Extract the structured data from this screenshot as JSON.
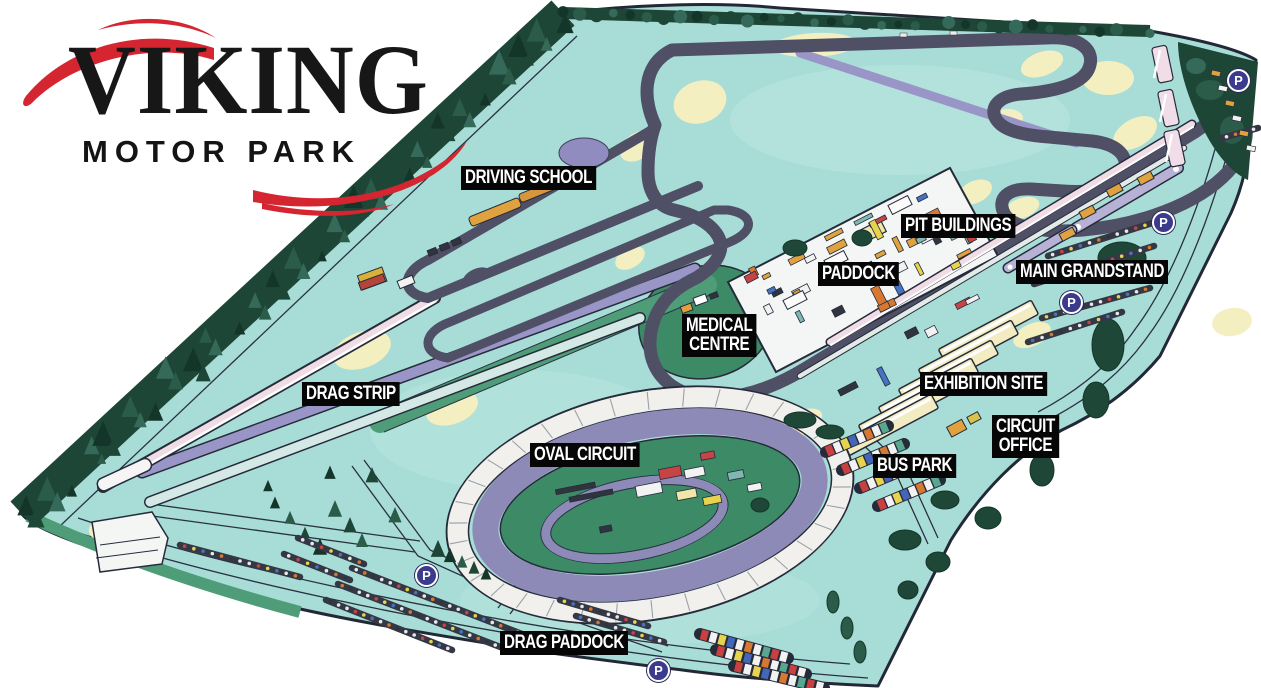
{
  "logo": {
    "title": "VIKING",
    "subtitle": "MOTOR PARK",
    "accent_color": "#d42531",
    "text_color": "#171717"
  },
  "map": {
    "background_color": "#ffffff",
    "land_color": "#a8ddd7",
    "track_color": "#4f4f66",
    "oval_track_color": "#8e8ab8",
    "infield_green": "#3d8a66",
    "runoff_cream": "#f4efc0",
    "tree_green": "#1e4636",
    "parking_symbol": "P",
    "parking_count": 5,
    "labels": [
      {
        "id": "driving-school",
        "text": "DRIVING SCHOOL"
      },
      {
        "id": "pit-buildings",
        "text": "PIT BUILDINGS"
      },
      {
        "id": "paddock",
        "text": "PADDOCK"
      },
      {
        "id": "main-grandstand",
        "text": "MAIN GRANDSTAND"
      },
      {
        "id": "medical-centre",
        "text": "MEDICAL\nCENTRE"
      },
      {
        "id": "exhibition-site",
        "text": "EXHIBITION SITE"
      },
      {
        "id": "circuit-office",
        "text": "CIRCUIT\nOFFICE"
      },
      {
        "id": "bus-park",
        "text": "BUS PARK"
      },
      {
        "id": "drag-strip",
        "text": "DRAG STRIP"
      },
      {
        "id": "oval-circuit",
        "text": "OVAL CIRCUIT"
      },
      {
        "id": "drag-paddock",
        "text": "DRAG PADDOCK"
      }
    ]
  }
}
